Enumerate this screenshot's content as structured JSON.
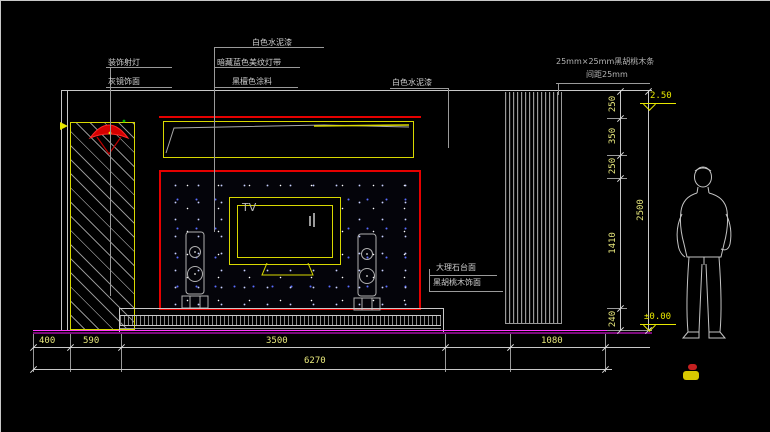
{
  "drawing": {
    "notes": {
      "spotlight": "装饰射灯",
      "mirror": "灰镜饰面",
      "white_paint_top": "白色水泥漆",
      "hidden_light": "暗藏蓝色美纹灯带",
      "dark_paint": "黑檀色涂料",
      "white_paint_right": "白色水泥漆",
      "slats_spec": "25mm×25mm黑胡桃木条",
      "slats_spacing": "间距25mm",
      "marble_top": "大理石台面",
      "walnut_veneer": "黑胡桃木饰面",
      "tv": "TV"
    },
    "dims_bottom": {
      "seg1": "400",
      "seg2": "590",
      "seg3": "3500",
      "seg4": "1080",
      "total": "6270"
    },
    "dims_right": {
      "seg1": "250",
      "seg2": "350",
      "seg3": "250",
      "seg4": "1410",
      "seg5": "240",
      "total": "2500"
    },
    "levels": {
      "top": "2.50",
      "floor": "±0.00"
    },
    "colors": {
      "accent_red": "#e60000",
      "cad_yellow": "#d8d800",
      "dim_yellow": "#e8e87c",
      "floor_magenta": "#ff35ff",
      "line_gray": "#c8c8c8"
    }
  }
}
